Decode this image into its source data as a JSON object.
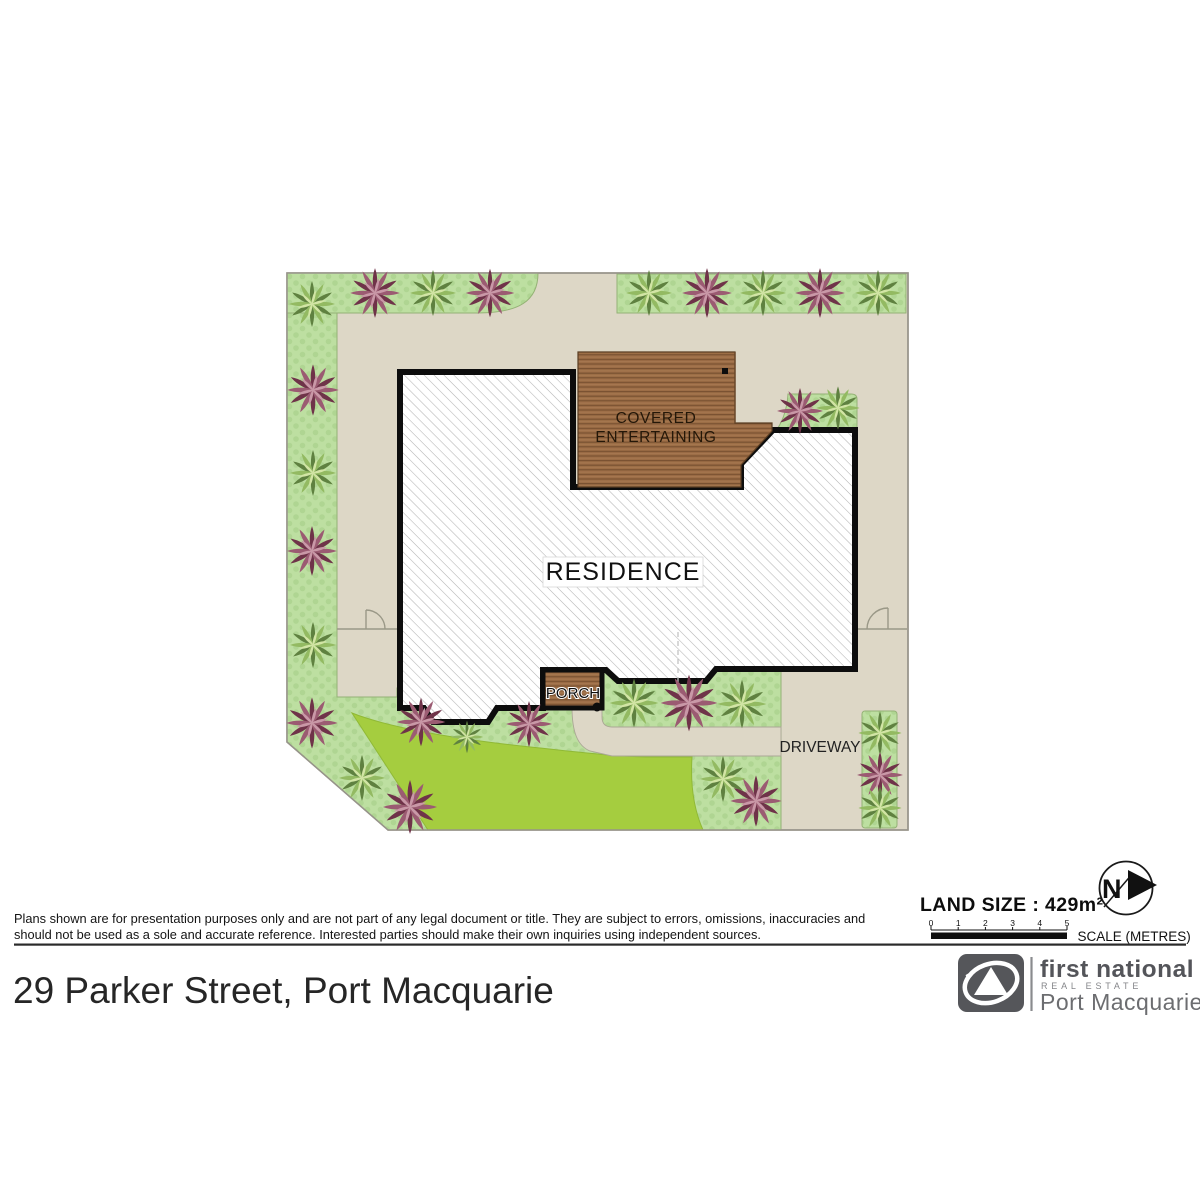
{
  "plan": {
    "residence_label": "RESIDENCE",
    "covered_entertaining_line1": "COVERED",
    "covered_entertaining_line2": "ENTERTAINING",
    "porch_label": "PORCH",
    "driveway_label": "DRIVEWAY",
    "colors": {
      "ground": "#ddd7c6",
      "garden_green": "#bddfa1",
      "lawn_green": "#a5cd3f",
      "deck_brown": "#9c6d46",
      "residence_fill": "#ffffff",
      "outline_black": "#0d0d0d",
      "plant_purple": "#6f3349",
      "plant_green": "#5f8140"
    }
  },
  "annotations": {
    "land_size": "LAND SIZE : 429m²",
    "scale_label": "SCALE (METRES)",
    "scale_ticks": [
      "0",
      "1",
      "2",
      "3",
      "4",
      "5"
    ],
    "north_label": "N"
  },
  "disclaimer": {
    "line1": "Plans shown are for presentation purposes only and are not part of any legal document or title. They are subject to errors, omissions, inaccuracies and",
    "line2": "should not be used as a sole and accurate reference. Interested parties should make their own inquiries using independent sources."
  },
  "address": "29 Parker Street, Port Macquarie",
  "logo": {
    "brand": "first national",
    "division": "REAL ESTATE",
    "office": "Port Macquarie"
  }
}
